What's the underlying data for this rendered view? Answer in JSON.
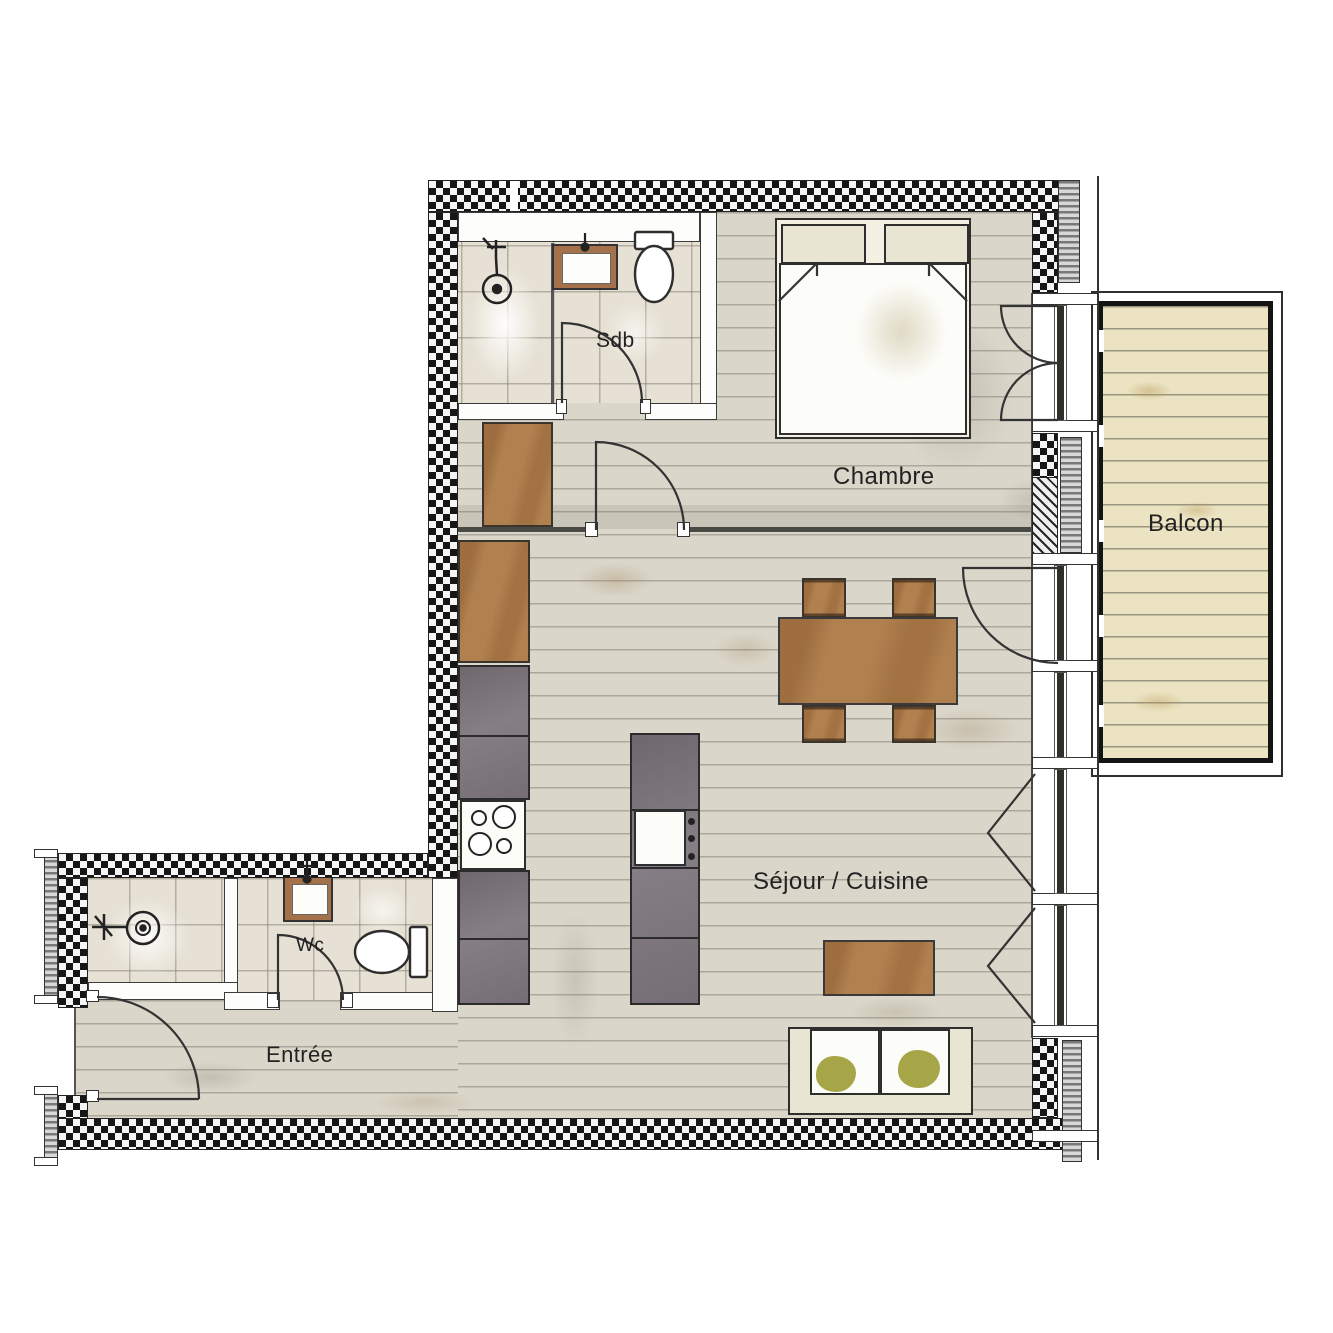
{
  "plan": {
    "type": "apartment-floor-plan",
    "rooms": [
      {
        "id": "sdb",
        "label": "Sdb"
      },
      {
        "id": "chambre",
        "label": "Chambre"
      },
      {
        "id": "balcon",
        "label": "Balcon"
      },
      {
        "id": "sejour_cuisine",
        "label": "Séjour / Cuisine"
      },
      {
        "id": "wc",
        "label": "Wc"
      },
      {
        "id": "entree",
        "label": "Entrée"
      }
    ],
    "colors": {
      "wall_black": "#161616",
      "wood_floor": "#dad6c9",
      "tile_floor": "#e6e1d4",
      "balcony_deck": "#ebe3c2",
      "furniture_brown": "#b0804f",
      "counter_gray": "#867e85",
      "vanity_brown": "#a5714a",
      "cushion_olive": "#a6a648"
    }
  }
}
